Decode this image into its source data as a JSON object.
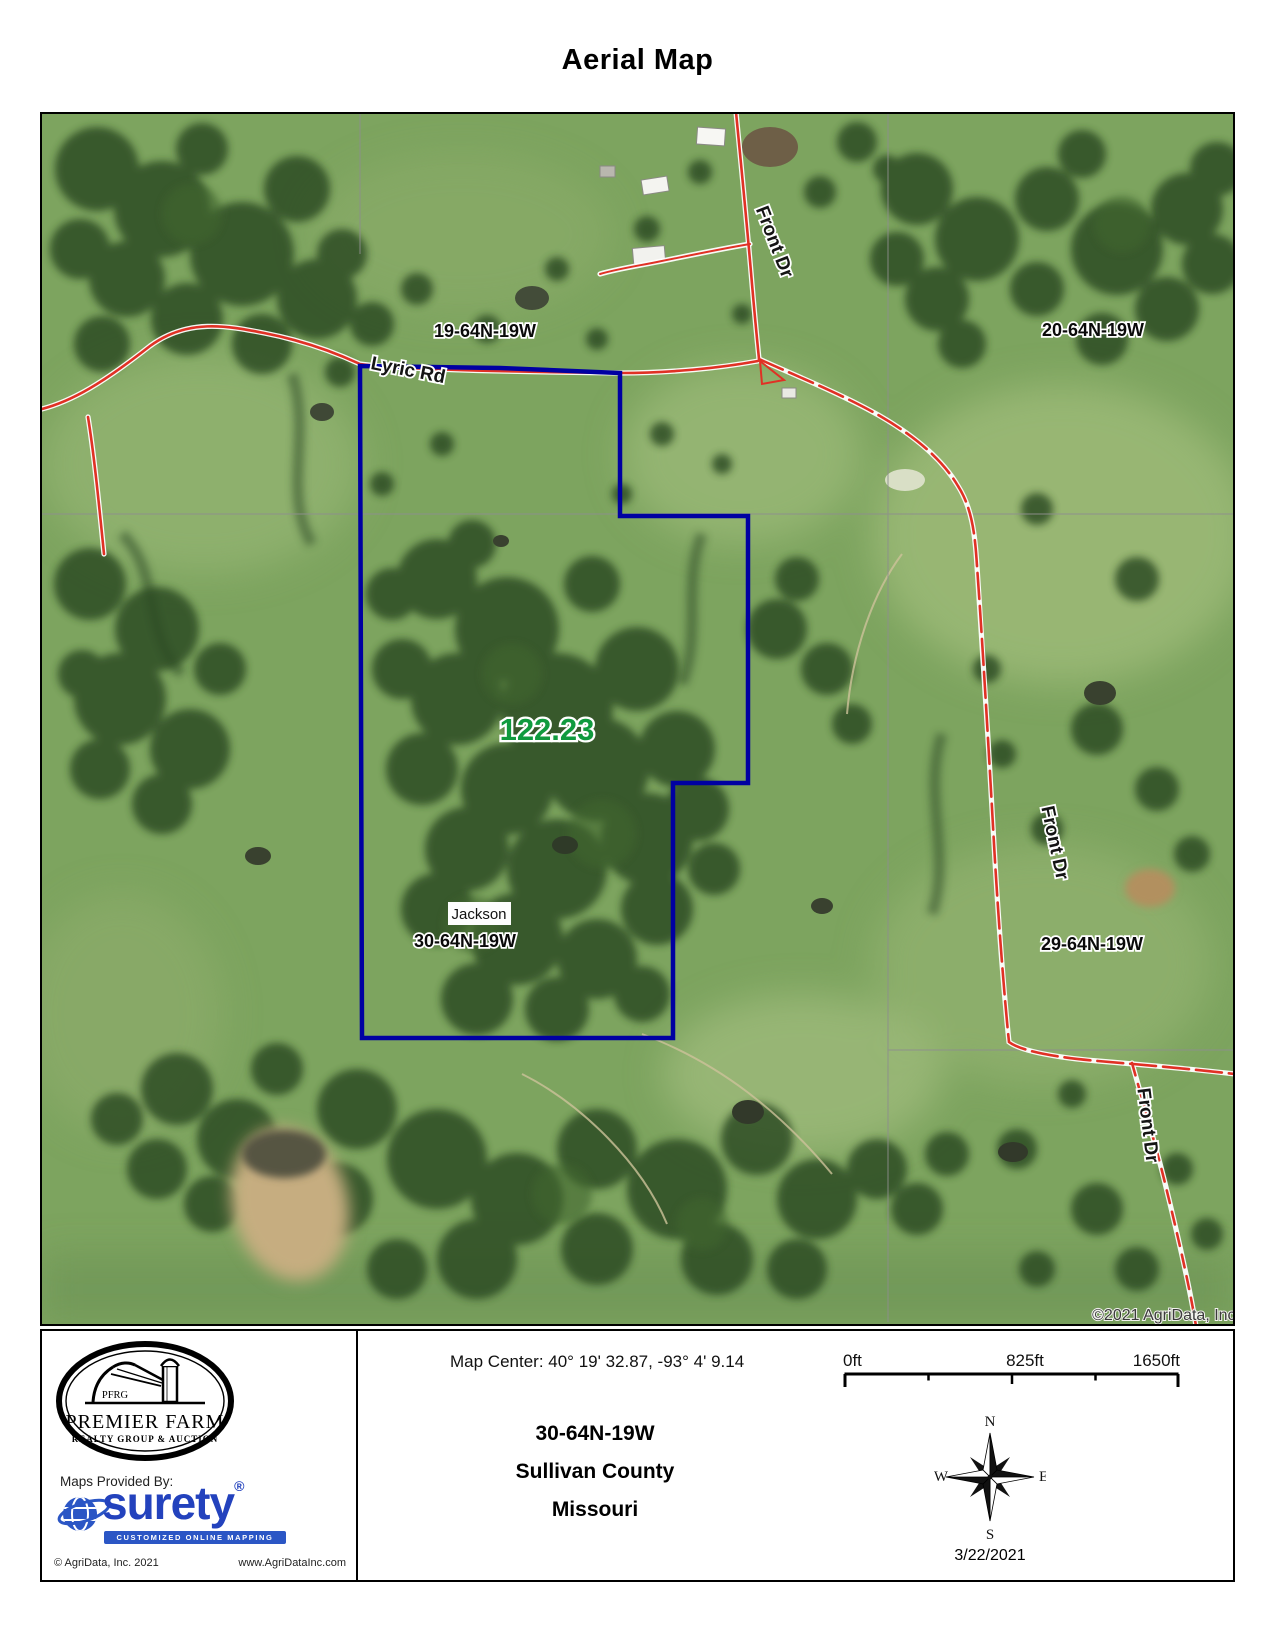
{
  "title": "Aerial Map",
  "map": {
    "acreage": "122.23",
    "sections": {
      "s19": "19-64N-19W",
      "s20": "20-64N-19W",
      "s29": "29-64N-19W",
      "s30": "30-64N-19W"
    },
    "township": "Jackson",
    "roads": {
      "lyric": "Lyric Rd",
      "front_top": "Front Dr",
      "front_right": "Front Dr",
      "front_bottom": "Front Dr"
    },
    "copyright": "©2021 AgriData, Inc.",
    "boundary_color": "#0000a2",
    "road_color": "#e03125"
  },
  "footer": {
    "premier_farm": {
      "initials": "PFRG",
      "name": "PREMIER FARM",
      "tagline": "REALTY GROUP & AUCTION"
    },
    "provider": {
      "label": "Maps Provided By:",
      "brand": "surety",
      "registered": "®",
      "tagline": "CUSTOMIZED ONLINE MAPPING",
      "copyright": "© AgriData, Inc. 2021",
      "website": "www.AgriDataInc.com"
    },
    "map_center": "Map Center: 40° 19' 32.87,  -93° 4' 9.14",
    "scale_bar": {
      "start": "0ft",
      "middle": "825ft",
      "end": "1650ft"
    },
    "location": {
      "section": "30-64N-19W",
      "county": "Sullivan County",
      "state": "Missouri"
    },
    "compass": {
      "north": "N",
      "east": "E",
      "south": "S",
      "west": "W"
    },
    "date": "3/22/2021"
  }
}
